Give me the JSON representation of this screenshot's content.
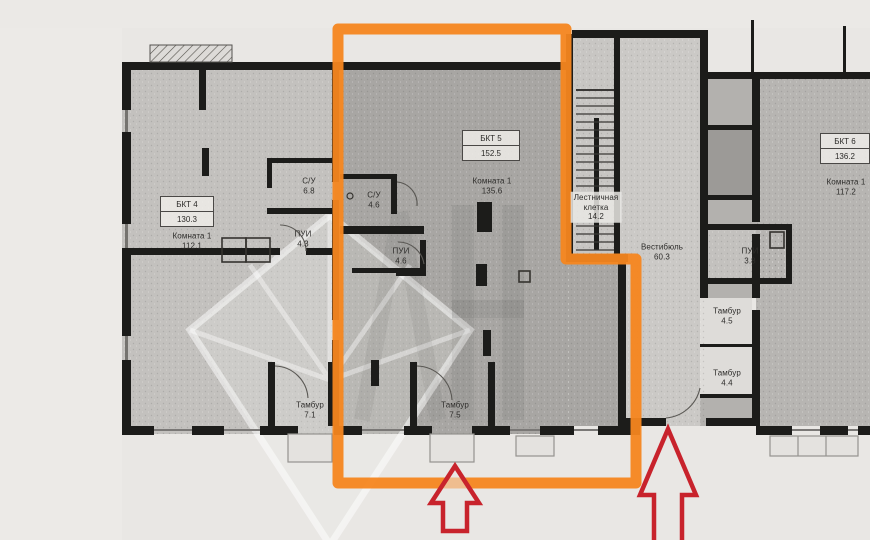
{
  "floor_plan": {
    "units": [
      {
        "name": "БКТ 4",
        "area": "130.3",
        "highlighted": false,
        "room": {
          "name": "Комната 1",
          "area": "112.1"
        },
        "sub_rooms": [
          {
            "name": "С/У",
            "area": "6.8"
          },
          {
            "name": "ПУИ",
            "area": "4.3"
          },
          {
            "name": "Тамбур",
            "area": "7.1"
          }
        ]
      },
      {
        "name": "БКТ 5",
        "area": "152.5",
        "highlighted": true,
        "room": {
          "name": "Комната 1",
          "area": "135.6"
        },
        "sub_rooms": [
          {
            "name": "С/У",
            "area": "4.6"
          },
          {
            "name": "ПУИ",
            "area": "4.6"
          },
          {
            "name": "Тамбур",
            "area": "7.5"
          }
        ]
      },
      {
        "name": "БКТ 6",
        "area": "136.2",
        "highlighted": false,
        "room": {
          "name": "Комната 1",
          "area": "117.2"
        },
        "sub_rooms": []
      }
    ],
    "common_areas": {
      "stair": {
        "name_line1": "Лестничная",
        "name_line2": "клетка",
        "area": "14.2"
      },
      "vestibule": {
        "name": "Вестибюль",
        "area": "60.3"
      },
      "pui": {
        "name": "ПУИ",
        "area": "3.8"
      },
      "tambur_upper": {
        "name": "Тамбур",
        "area": "4.5"
      },
      "tambur_lower": {
        "name": "Тамбур",
        "area": "4.4"
      }
    },
    "annotations": {
      "highlight_color": "#f6861f",
      "arrow_color": "#c8232c"
    }
  }
}
